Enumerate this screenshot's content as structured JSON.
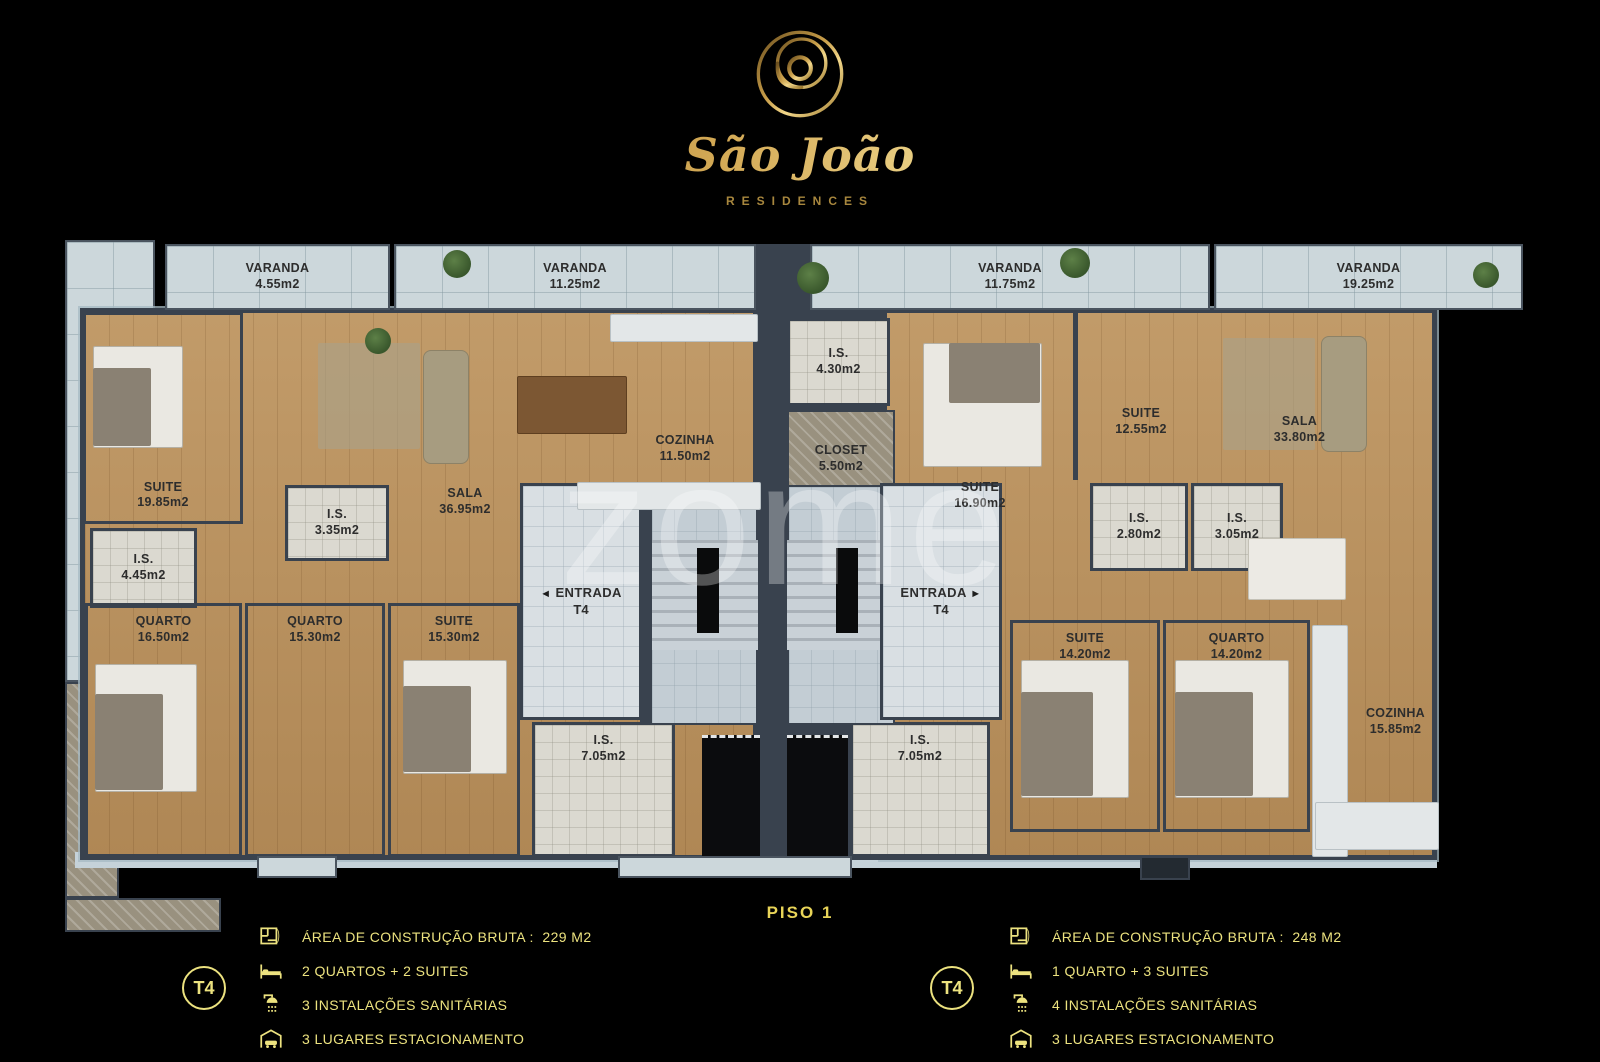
{
  "brand": {
    "name": "São João",
    "subtitle": "RESIDENCES",
    "logo_icon": "spiral-circle-logo"
  },
  "floor_label": "PISO 1",
  "watermark": "zome",
  "rooms": [
    {
      "id": "varanda-455",
      "name": "VARANDA",
      "area": "4.55m2"
    },
    {
      "id": "varanda-1125",
      "name": "VARANDA",
      "area": "11.25m2"
    },
    {
      "id": "varanda-1175",
      "name": "VARANDA",
      "area": "11.75m2"
    },
    {
      "id": "varanda-1925",
      "name": "VARANDA",
      "area": "19.25m2"
    },
    {
      "id": "suite-1985",
      "name": "SUITE",
      "area": "19.85m2"
    },
    {
      "id": "is-445",
      "name": "I.S.",
      "area": "4.45m2"
    },
    {
      "id": "is-335",
      "name": "I.S.",
      "area": "3.35m2"
    },
    {
      "id": "sala-3695",
      "name": "SALA",
      "area": "36.95m2"
    },
    {
      "id": "cozinha-1150",
      "name": "COZINHA",
      "area": "11.50m2"
    },
    {
      "id": "quarto-1650",
      "name": "QUARTO",
      "area": "16.50m2"
    },
    {
      "id": "quarto-1530",
      "name": "QUARTO",
      "area": "15.30m2"
    },
    {
      "id": "suite-1530",
      "name": "SUITE",
      "area": "15.30m2"
    },
    {
      "id": "is-705-left",
      "name": "I.S.",
      "area": "7.05m2"
    },
    {
      "id": "is-430",
      "name": "I.S.",
      "area": "4.30m2"
    },
    {
      "id": "closet-550",
      "name": "CLOSET",
      "area": "5.50m2"
    },
    {
      "id": "suite-1690",
      "name": "SUITE",
      "area": "16.90m2"
    },
    {
      "id": "suite-1255",
      "name": "SUITE",
      "area": "12.55m2"
    },
    {
      "id": "is-280",
      "name": "I.S.",
      "area": "2.80m2"
    },
    {
      "id": "is-305",
      "name": "I.S.",
      "area": "3.05m2"
    },
    {
      "id": "sala-3380",
      "name": "SALA",
      "area": "33.80m2"
    },
    {
      "id": "suite-1420",
      "name": "SUITE",
      "area": "14.20m2"
    },
    {
      "id": "quarto-1420",
      "name": "QUARTO",
      "area": "14.20m2"
    },
    {
      "id": "cozinha-1585",
      "name": "COZINHA",
      "area": "15.85m2"
    },
    {
      "id": "is-705-right",
      "name": "I.S.",
      "area": "7.05m2"
    }
  ],
  "entrances": [
    {
      "name": "ENTRADA",
      "unit": "T4",
      "arrow": "◄",
      "arrow_position": "before"
    },
    {
      "name": "ENTRADA",
      "unit": "T4",
      "arrow": "►",
      "arrow_position": "after"
    }
  ],
  "legends": [
    {
      "unit": "T4",
      "items": [
        {
          "icon": "floorplan-icon",
          "text": "ÁREA DE CONSTRUÇÃO BRUTA :  229 M2"
        },
        {
          "icon": "bed-icon",
          "text": "2 QUARTOS + 2 SUITES"
        },
        {
          "icon": "shower-icon",
          "text": "3 INSTALAÇÕES SANITÁRIAS"
        },
        {
          "icon": "garage-icon",
          "text": "3 LUGARES ESTACIONAMENTO"
        }
      ]
    },
    {
      "unit": "T4",
      "items": [
        {
          "icon": "floorplan-icon",
          "text": "ÁREA DE CONSTRUÇÃO BRUTA :  248 M2"
        },
        {
          "icon": "bed-icon",
          "text": "1 QUARTO + 3 SUITES"
        },
        {
          "icon": "shower-icon",
          "text": "4 INSTALAÇÕES SANITÁRIAS"
        },
        {
          "icon": "garage-icon",
          "text": "3 LUGARES ESTACIONAMENTO"
        }
      ]
    }
  ],
  "colors": {
    "background": "#000000",
    "legend_gold": "#ece27f",
    "piso_gold": "#e8d458",
    "logo_gold": "#c9a34f",
    "wall": "#39424e",
    "wood_floor": "#b9905c",
    "terrace_floor": "#ccd7db",
    "room_label": "#2d2d2d"
  }
}
